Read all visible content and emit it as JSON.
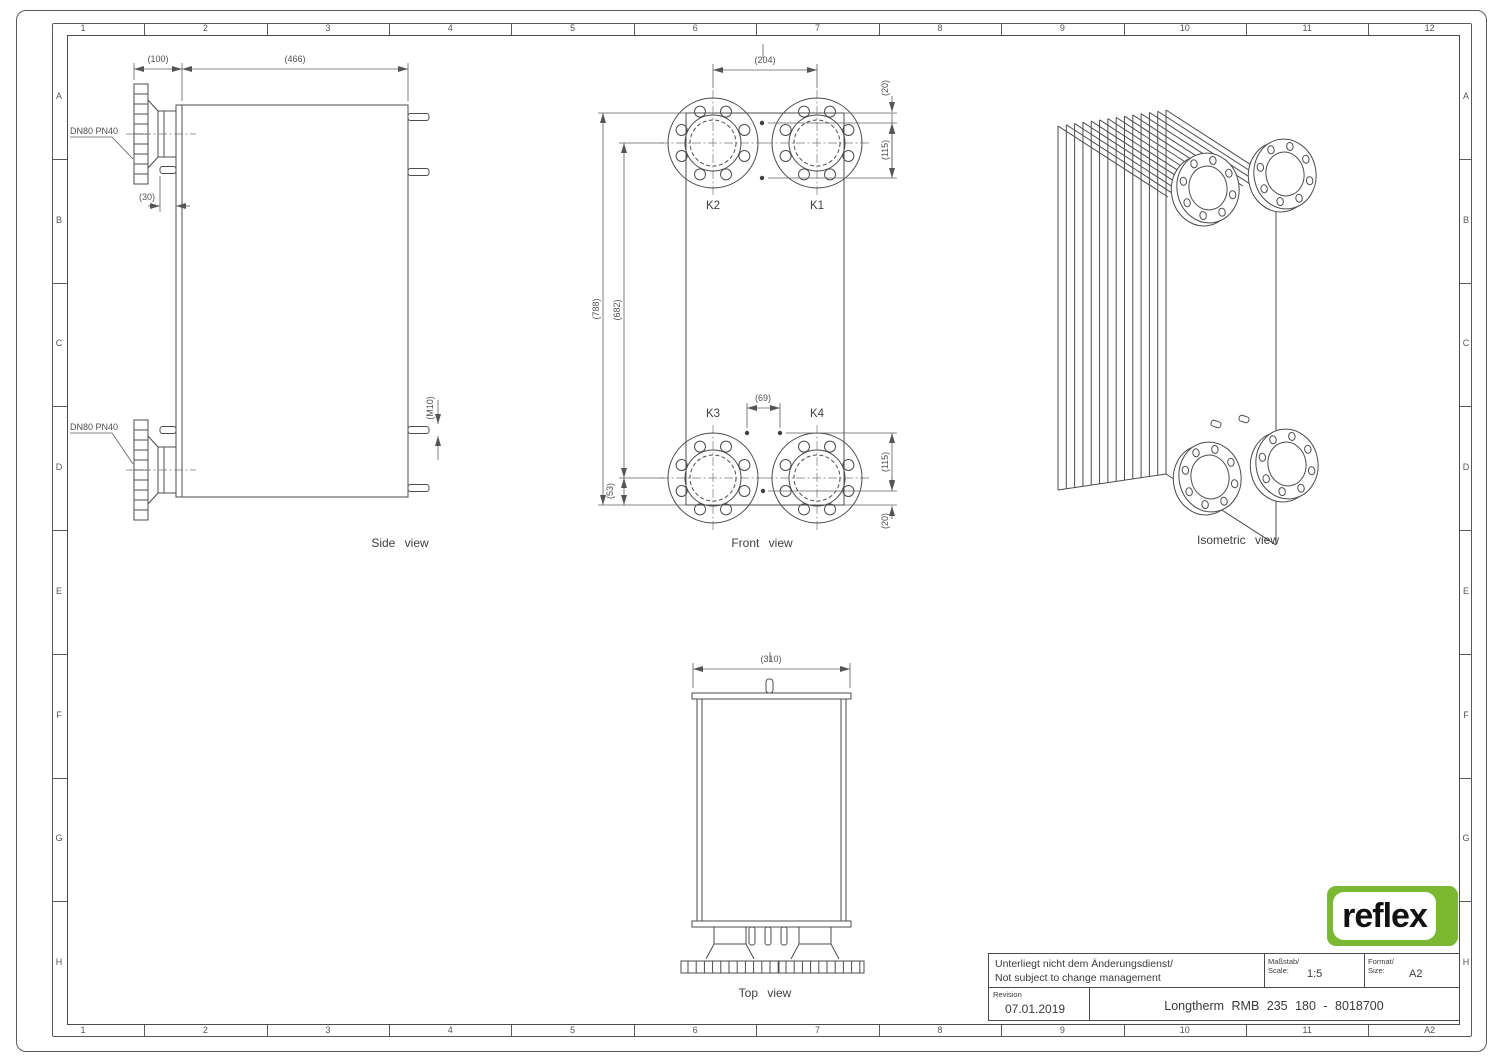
{
  "sheet": {
    "zones": {
      "top": [
        "1",
        "2",
        "3",
        "4",
        "5",
        "6",
        "7",
        "8",
        "9",
        "10",
        "11",
        "12"
      ],
      "bottom": [
        "1",
        "2",
        "3",
        "4",
        "5",
        "6",
        "7",
        "8",
        "9",
        "10",
        "11",
        "A2"
      ],
      "left": [
        "A",
        "B",
        "C",
        "D",
        "E",
        "F",
        "G",
        "H"
      ],
      "right": [
        "A",
        "B",
        "C",
        "D",
        "E",
        "F",
        "G",
        "H"
      ]
    }
  },
  "views": {
    "side": {
      "label": "Side view",
      "dim_width_nozzle": "(100)",
      "dim_width_body": "(466)",
      "dim_stud": "(30)",
      "dim_thread": "(M10)",
      "nozzle_top_label": "DN80 PN40",
      "nozzle_bottom_label": "DN80 PN40"
    },
    "front": {
      "label": "Front view",
      "ports": {
        "k1": "K1",
        "k2": "K2",
        "k3": "K3",
        "k4": "K4"
      },
      "dim_port_spacing_h": "(204)",
      "dim_height_overall": "(788)",
      "dim_port_spacing_v": "(682)",
      "dim_top_offset": "(20)",
      "dim_top_stud_spacing": "(115)",
      "dim_stud_pair": "(69)",
      "dim_bottom_flange_offset": "(53)",
      "dim_bottom_stud_spacing": "(115)",
      "dim_bottom_offset": "(20)"
    },
    "top": {
      "label": "Top view",
      "dim_depth": "(310)"
    },
    "iso": {
      "label": "Isometric view"
    }
  },
  "title_block": {
    "note_line1": "Unterliegt nicht dem Änderungsdienst/",
    "note_line2": "Not subject to change management",
    "scale_label_de": "Maßstab/",
    "scale_label_en": "Scale:",
    "scale_value": "1:5",
    "format_label_de": "Format/",
    "format_label_en": "Size:",
    "format_value": "A2",
    "revision_label": "Revision",
    "revision_date": "07.01.2019",
    "product": "Longtherm RMB 235 180 - 8018700"
  },
  "logo": {
    "text": "reflex",
    "green": "#7cb933"
  }
}
